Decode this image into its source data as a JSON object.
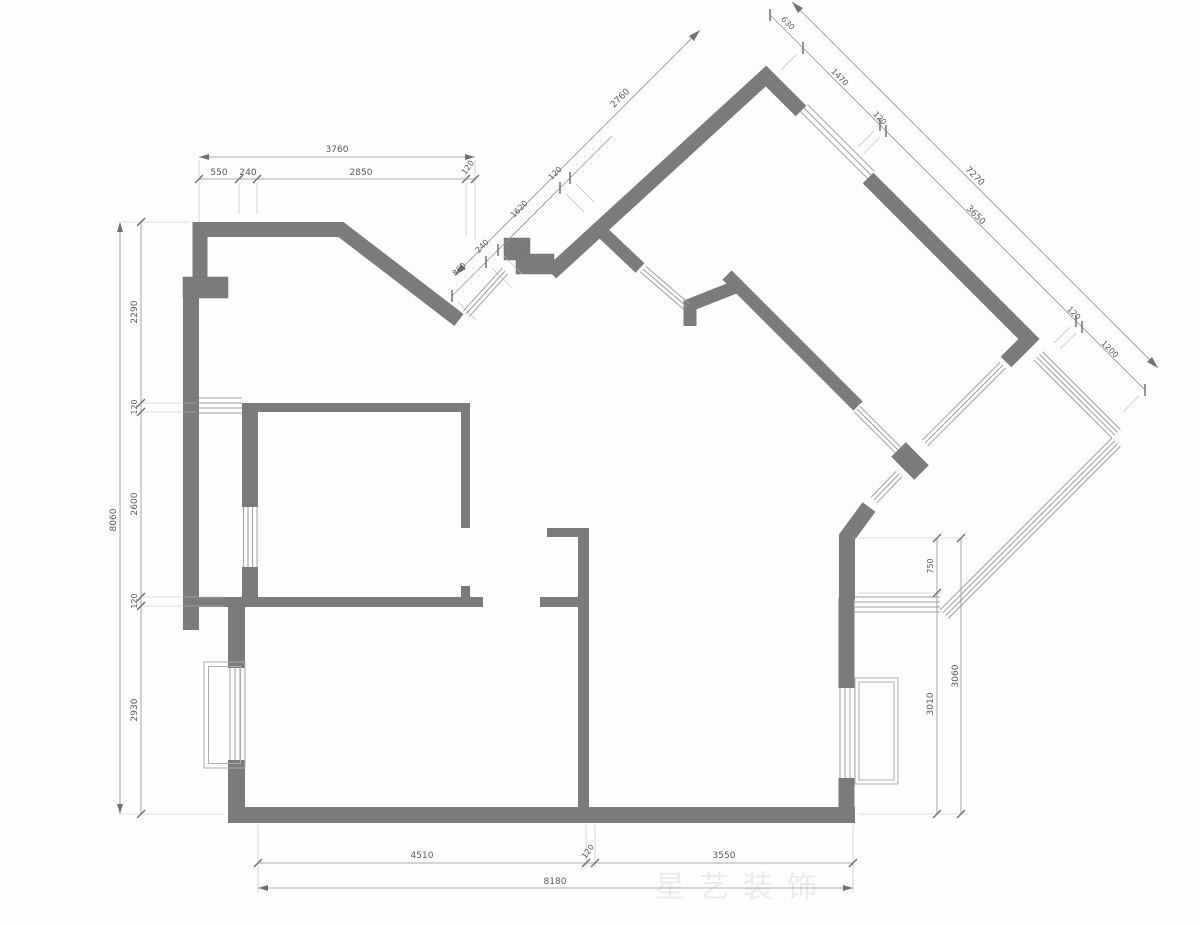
{
  "watermark": {
    "text": "星艺装饰"
  },
  "dims": {
    "top": {
      "total": "3760",
      "s": [
        "550",
        "240",
        "2850",
        "120"
      ]
    },
    "left": {
      "total": "8060",
      "s": [
        "2290",
        "120",
        "2600",
        "120",
        "2930"
      ]
    },
    "bottom": {
      "total": "8180",
      "s": [
        "4510",
        "120",
        "3550"
      ]
    },
    "entry": {
      "total": "2760",
      "s": [
        "860",
        "240",
        "1620",
        "120"
      ]
    },
    "tr": {
      "total": "7270",
      "s": [
        "630",
        "1470",
        "120",
        "3650",
        "120",
        "1200"
      ]
    },
    "right": {
      "s": [
        "750",
        "3010",
        "3060"
      ]
    }
  }
}
